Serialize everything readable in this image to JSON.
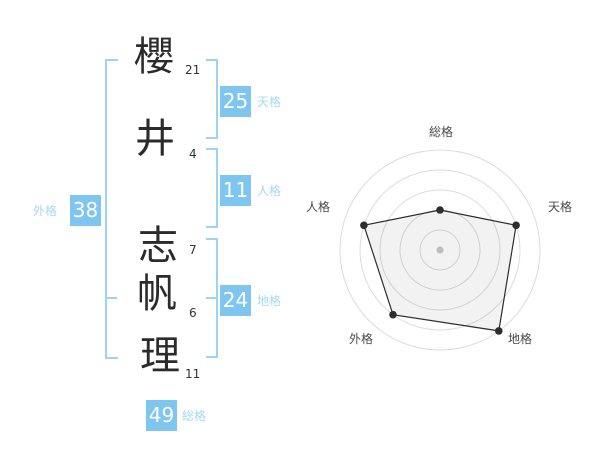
{
  "name_diagram": {
    "characters": [
      {
        "char": "櫻",
        "strokes": "21"
      },
      {
        "char": "井",
        "strokes": "4"
      },
      {
        "char": "志",
        "strokes": "7"
      },
      {
        "char": "帆",
        "strokes": "6"
      },
      {
        "char": "理",
        "strokes": "11"
      }
    ],
    "kaku": {
      "tenkaku": {
        "label": "天格",
        "value": "25"
      },
      "jinkaku": {
        "label": "人格",
        "value": "11"
      },
      "chikaku": {
        "label": "地格",
        "value": "24"
      },
      "gaikaku": {
        "label": "外格",
        "value": "38"
      },
      "soukaku": {
        "label": "総格",
        "value": "49"
      }
    }
  },
  "chart_data": {
    "type": "radar",
    "title": "",
    "categories": [
      "総格",
      "天格",
      "地格",
      "外格",
      "人格"
    ],
    "values": [
      40,
      80,
      100,
      80,
      80
    ],
    "max": 100,
    "grid_rings": [
      20,
      40,
      60,
      80,
      100
    ],
    "grid": "concentric-circles",
    "legend": "none"
  },
  "colors": {
    "box_blue": "#7ec5f0",
    "bracket_blue": "#9fd3f4",
    "kaku_label_blue": "#a5d8f5",
    "text_dark": "#333333",
    "radar_grid": "#dcdcdc",
    "radar_line": "#2e2e2e",
    "radar_fill": "rgba(0,0,0,0.05)",
    "radar_center_dot": "#c9c9c9"
  }
}
